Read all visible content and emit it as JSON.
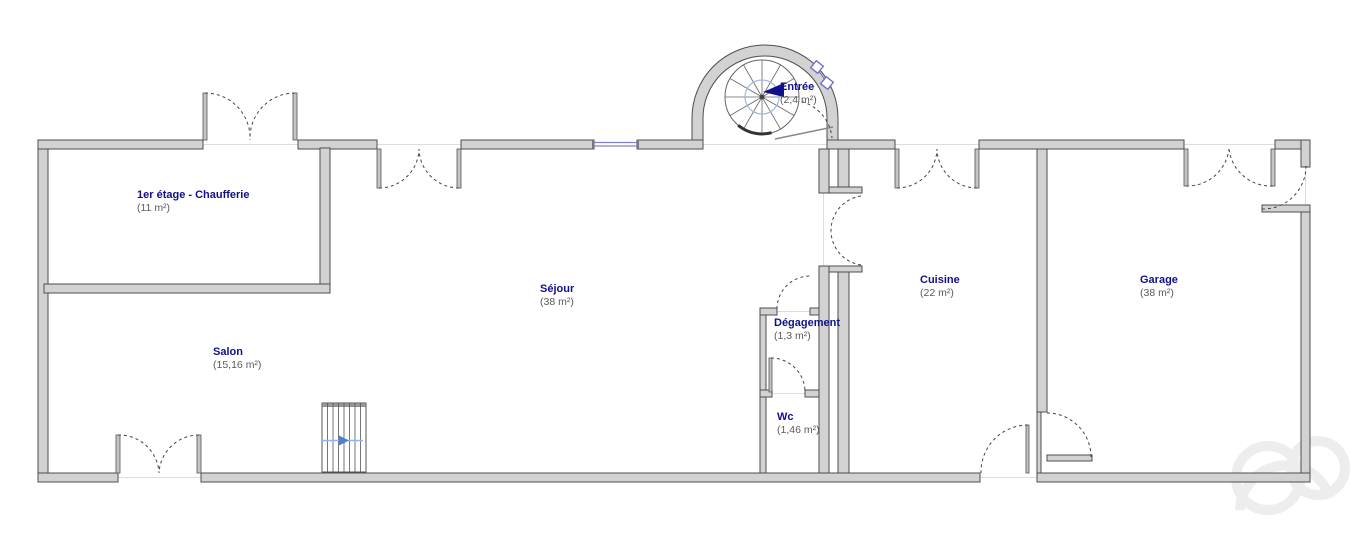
{
  "plan_type": "floor-plan",
  "rooms": [
    {
      "id": "chaufferie",
      "name": "1er étage - Chaufferie",
      "area": "(11 m²)"
    },
    {
      "id": "sejour",
      "name": "Séjour",
      "area": "(38 m²)"
    },
    {
      "id": "salon",
      "name": "Salon",
      "area": "(15,16 m²)"
    },
    {
      "id": "entree",
      "name": "Entrée",
      "area": "(2,4 m²)"
    },
    {
      "id": "degagement",
      "name": "Dégagement",
      "area": "(1,3 m²)"
    },
    {
      "id": "wc",
      "name": "Wc",
      "area": "(1,46 m²)"
    },
    {
      "id": "cuisine",
      "name": "Cuisine",
      "area": "(22 m²)"
    },
    {
      "id": "garage",
      "name": "Garage",
      "area": "(38 m²)"
    }
  ],
  "colors": {
    "wall_fill": "#d2d2d2",
    "wall_stroke": "#4d4d4d",
    "room_label": "#10108a",
    "area_text": "#5a5a5a",
    "window_blue": "#8080c8",
    "stair_arrow_blue": "#4a7fd4",
    "door_arc": "#444444",
    "watermark": "#ededed"
  }
}
